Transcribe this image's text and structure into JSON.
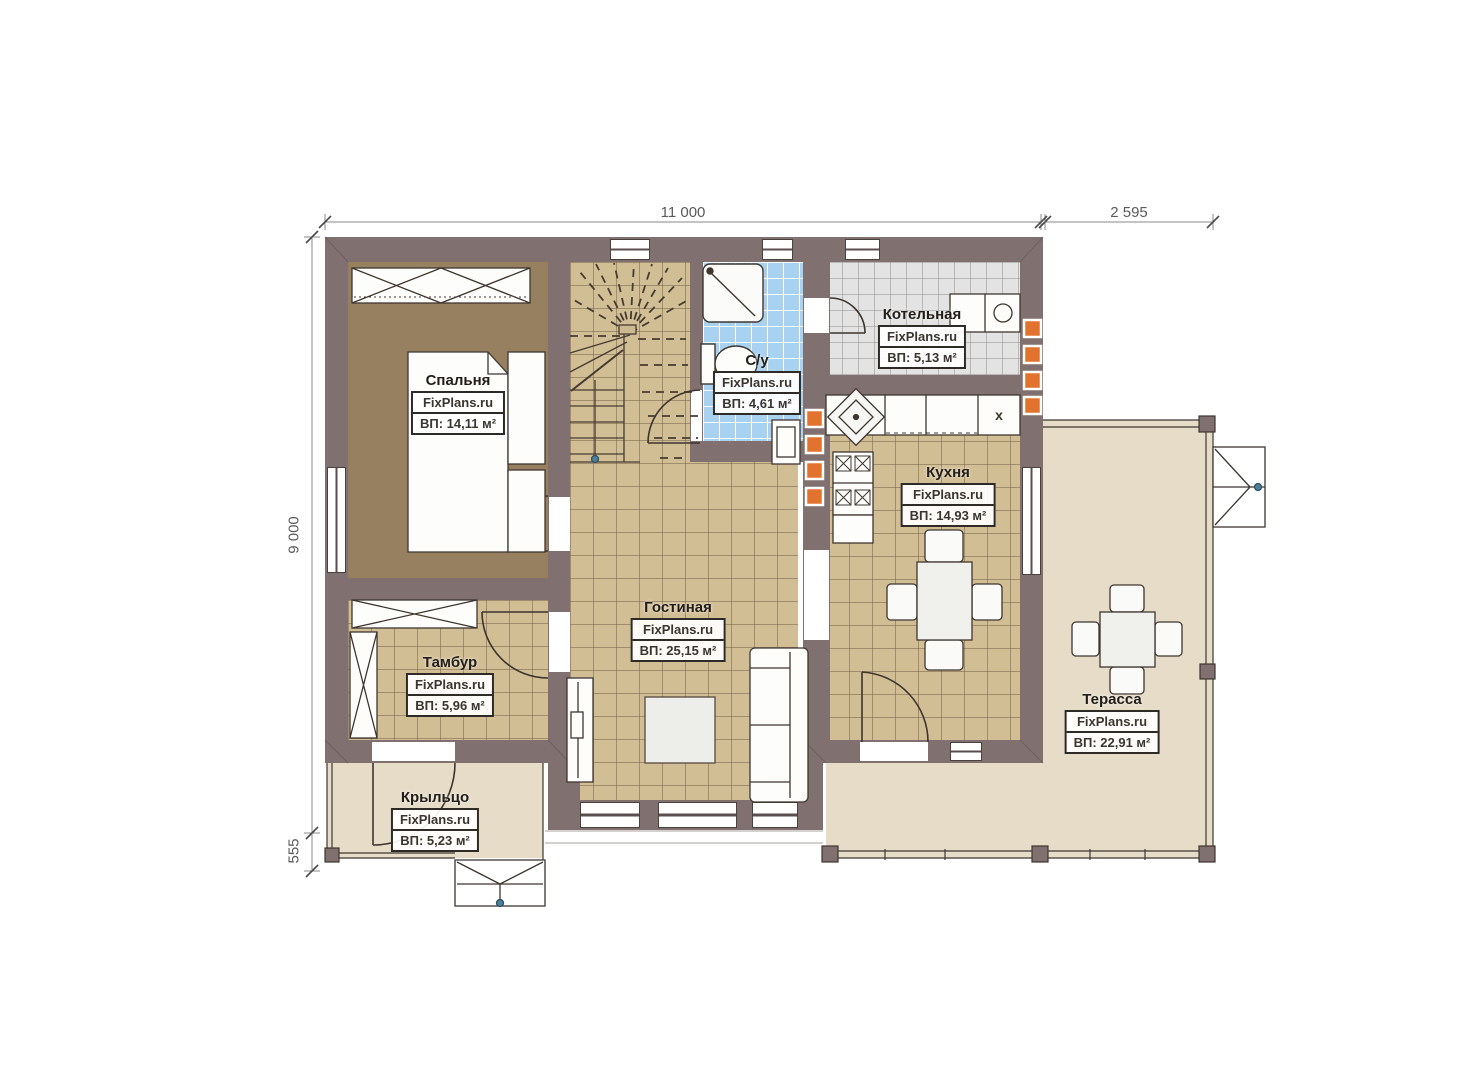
{
  "watermark": "FixPlans.ru",
  "rooms": [
    {
      "id": "bedroom",
      "name": "Спальня",
      "area": "ВП: 14,11 м²"
    },
    {
      "id": "bathroom",
      "name": "С/у",
      "area": "ВП: 4,61 м²"
    },
    {
      "id": "boiler",
      "name": "Котельная",
      "area": "ВП: 5,13 м²"
    },
    {
      "id": "kitchen",
      "name": "Кухня",
      "area": "ВП: 14,93 м²"
    },
    {
      "id": "living",
      "name": "Гостиная",
      "area": "ВП: 25,15 м²"
    },
    {
      "id": "vestibule",
      "name": "Тамбур",
      "area": "ВП: 5,96 м²"
    },
    {
      "id": "porch",
      "name": "Крыльцо",
      "area": "ВП: 5,23 м²"
    },
    {
      "id": "terrace",
      "name": "Терасса",
      "area": "ВП: 22,91 м²"
    }
  ],
  "dimensions": {
    "top_width": "11 000",
    "top_right_width": "2 595",
    "left_height": "9 000",
    "left_bottom": "555"
  },
  "kitchen_vent_mark": "x",
  "colors": {
    "wall": "#80706f",
    "tile_tan": "#d2be95",
    "tile_blue": "#a9d2f0",
    "tile_gray": "#e3e3e3",
    "wood_floor": "#96805f",
    "outdoor": "#e6dcc8",
    "vent_orange": "#e2732f",
    "line_dark": "#3f3630",
    "dim_text": "#5a5a5a"
  }
}
